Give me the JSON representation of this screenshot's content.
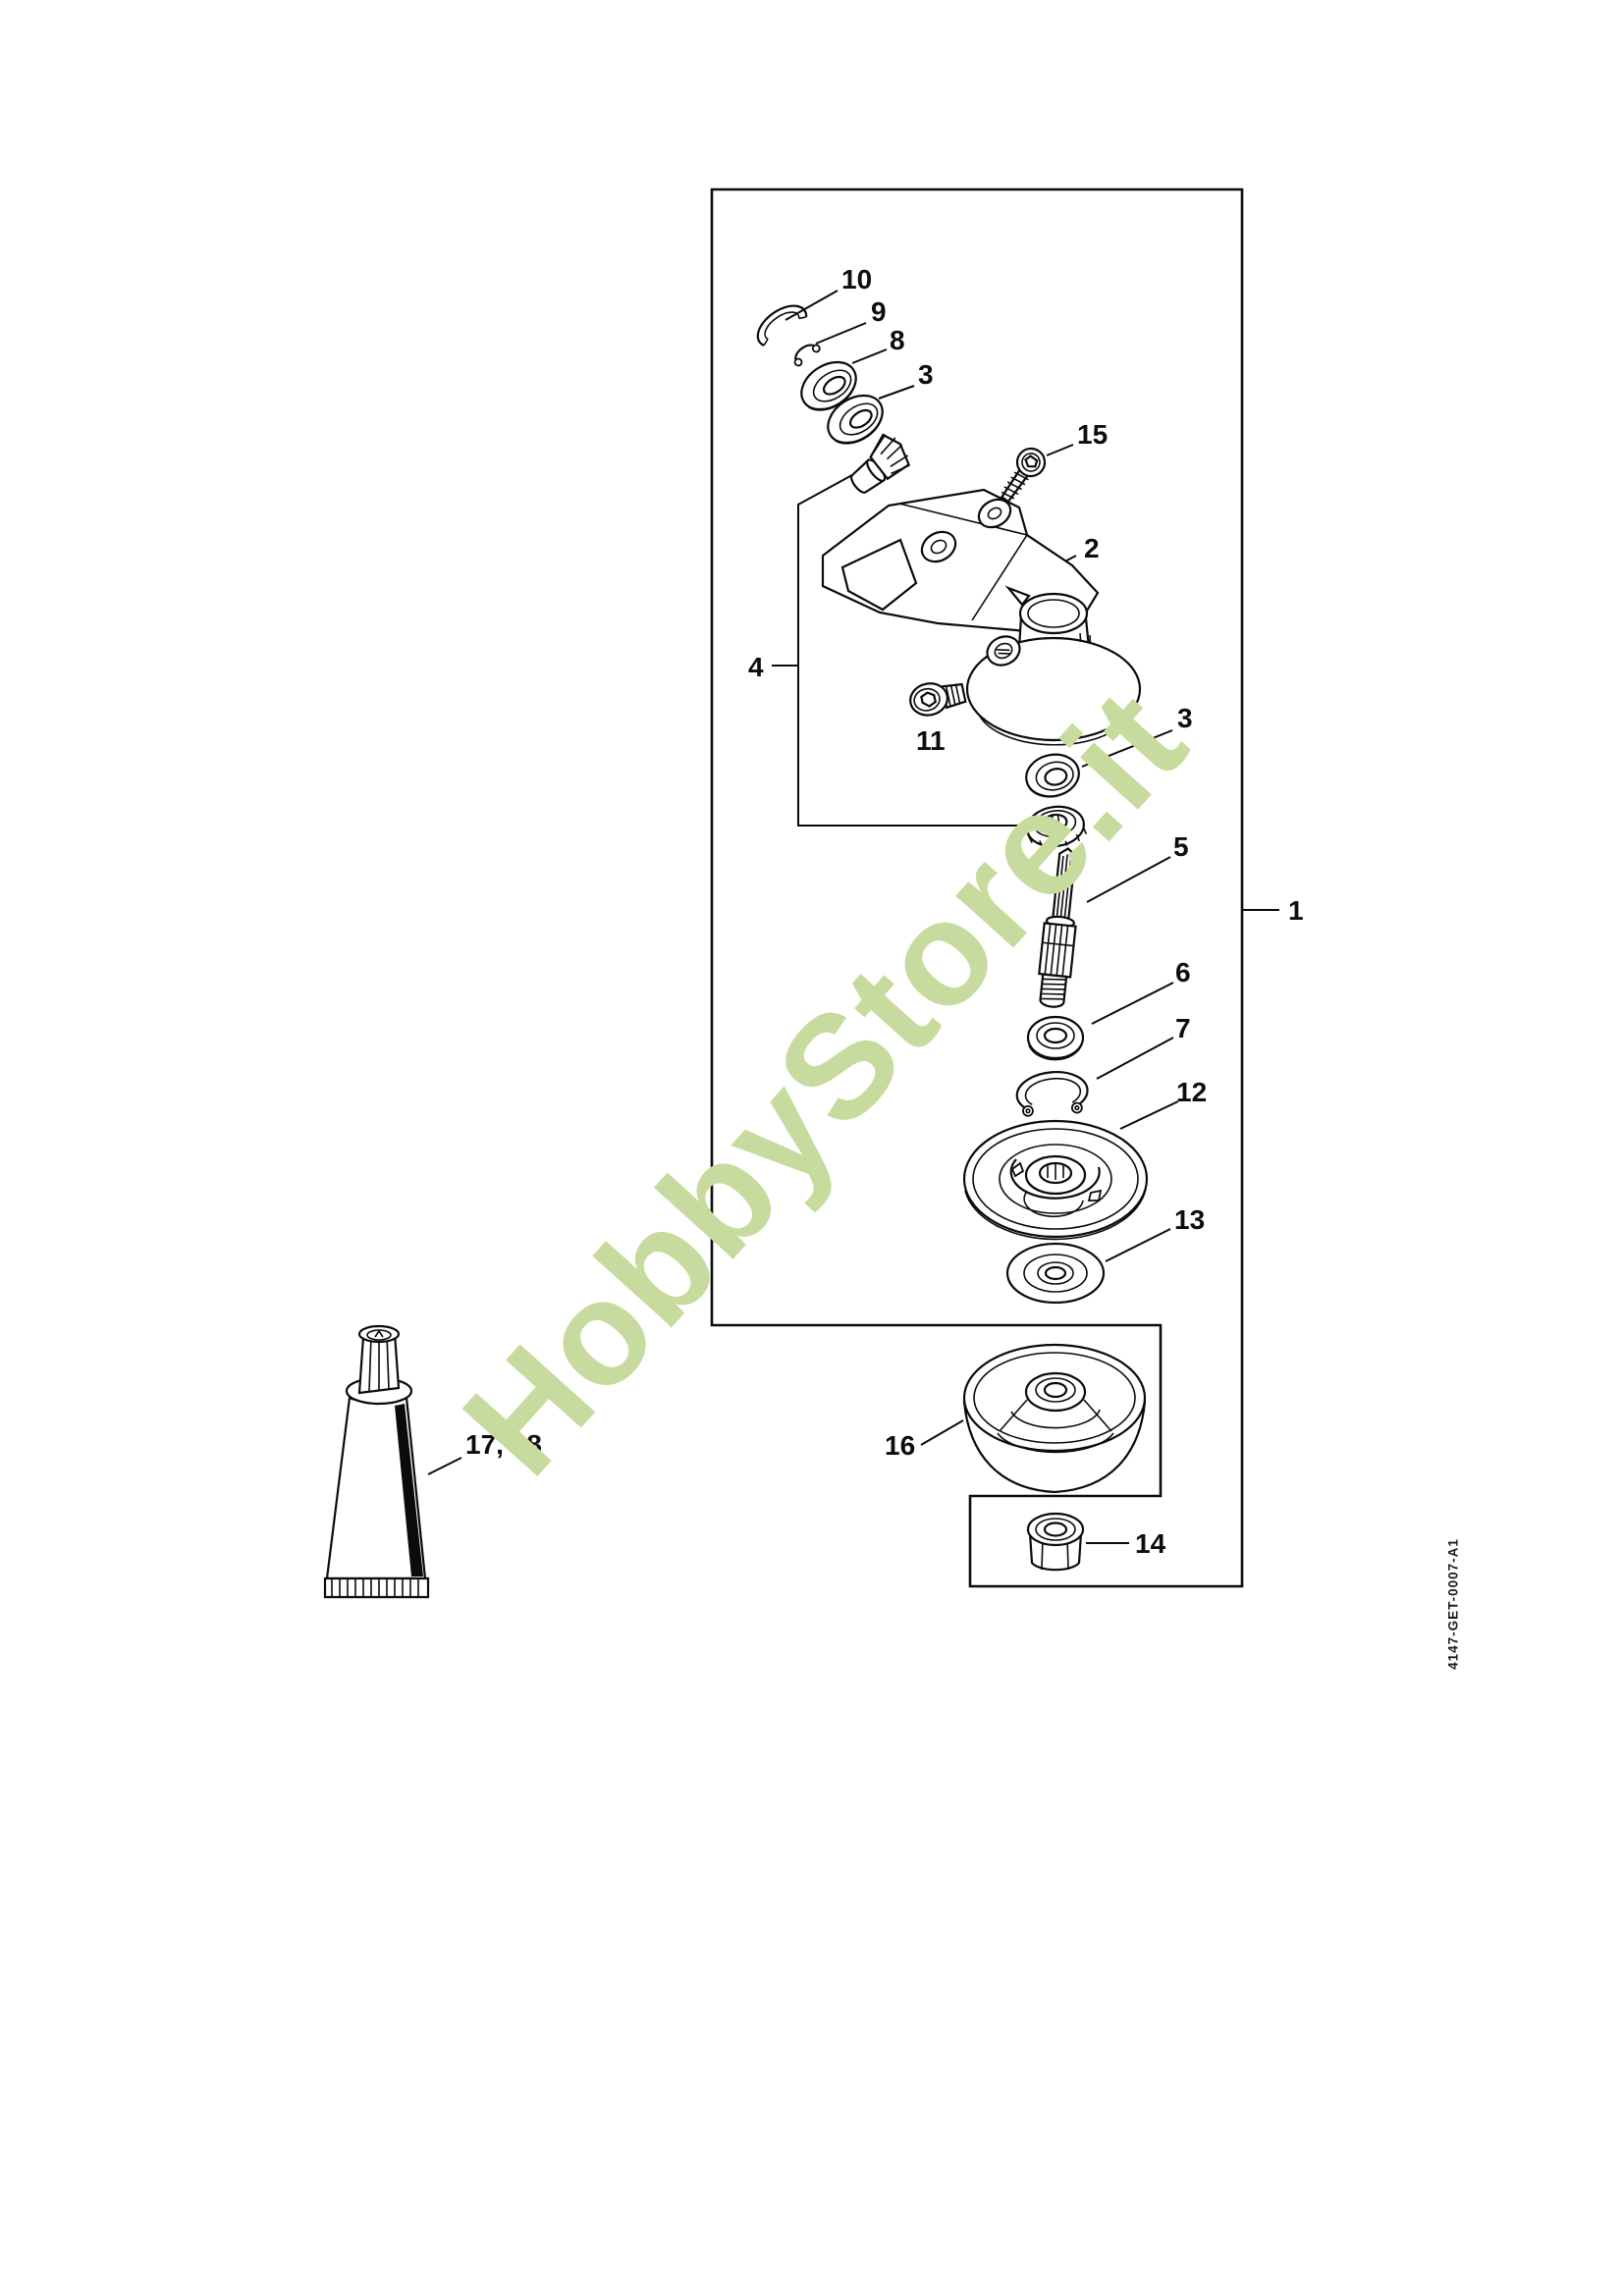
{
  "page": {
    "background": "#ffffff",
    "line_color": "#0b0b0b"
  },
  "watermark": {
    "text": "HobbyStore.it",
    "color": "#c8db9e"
  },
  "drawing_code": "4147-GET-0007-A1",
  "callouts": {
    "n10": "10",
    "n9": "9",
    "n8": "8",
    "n3_upper": "3",
    "n15": "15",
    "n2": "2",
    "n4": "4",
    "n11": "11",
    "n3_lower": "3",
    "n5": "5",
    "n1": "1",
    "n6": "6",
    "n7": "7",
    "n12": "12",
    "n13": "13",
    "n16": "16",
    "n14": "14",
    "n17_18": "17, 18"
  }
}
